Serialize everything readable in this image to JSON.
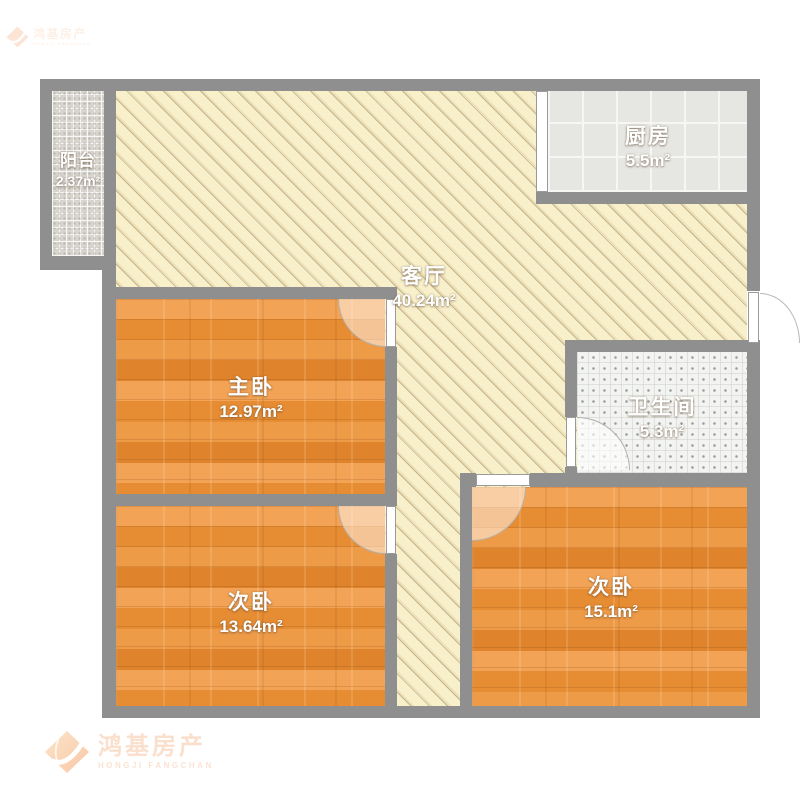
{
  "page": {
    "type": "apartment-floor-plan"
  },
  "watermark": {
    "company_cn": "鸿基房产",
    "company_en": "HONGJI FANGCHAN"
  },
  "rooms": [
    {
      "id": "balcony",
      "name": "阳台",
      "area": "2.37m²"
    },
    {
      "id": "living-room",
      "name": "客厅",
      "area": "40.24m²"
    },
    {
      "id": "kitchen",
      "name": "厨房",
      "area": "5.5m²"
    },
    {
      "id": "master-bedroom",
      "name": "主卧",
      "area": "12.97m²"
    },
    {
      "id": "bathroom",
      "name": "卫生间",
      "area": "5.3m²"
    },
    {
      "id": "second-bedroom-left",
      "name": "次卧",
      "area": "13.64m²"
    },
    {
      "id": "second-bedroom-right",
      "name": "次卧",
      "area": "15.1m²"
    }
  ],
  "colors": {
    "wall": "#8f8f8f",
    "wood_floor": "#e8913f",
    "living_floor": "#f8efcb",
    "kitchen_tile": "#e6e6e3",
    "bathroom_tile": "#f3f4f1",
    "balcony_tile": "#d8d5cf",
    "watermark_orange": "#f08a45"
  }
}
